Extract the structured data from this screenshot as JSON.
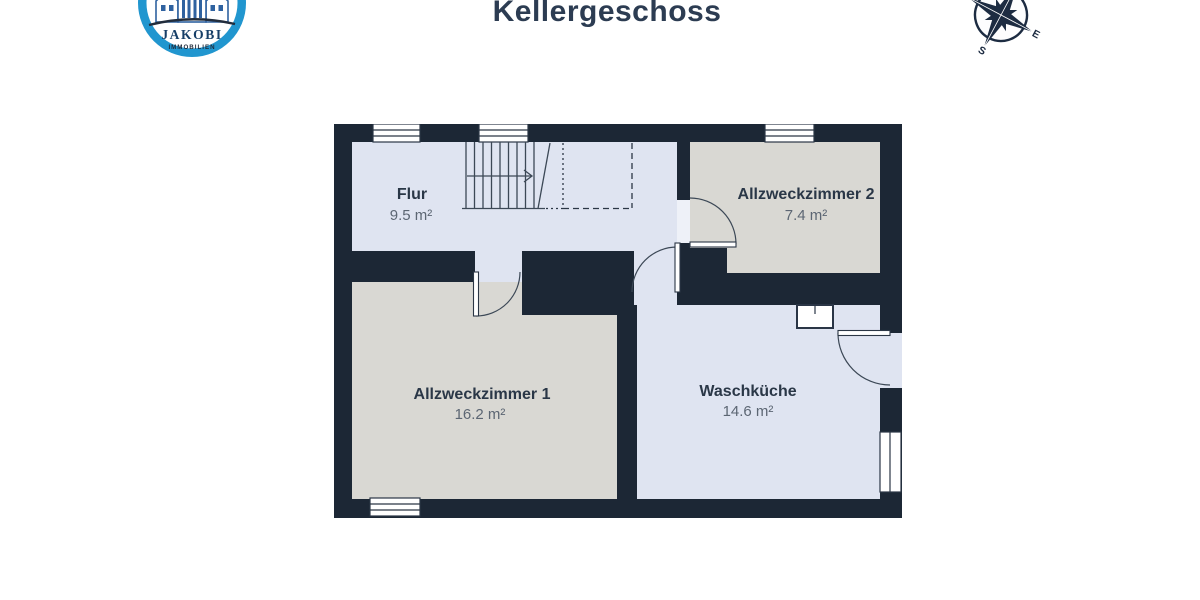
{
  "header": {
    "title": "Kellergeschoss",
    "title_color": "#2c3c52"
  },
  "logo": {
    "name": "JAKOBI",
    "subtitle": "IMMOBILIEN",
    "ring_color": "#2196cf",
    "building_color": "#2f62a0",
    "name_color": "#173f68",
    "subtitle_color": "#1d2838"
  },
  "compass": {
    "east": "E",
    "south": "S",
    "color": "#1d2c42"
  },
  "floorplan": {
    "wall_color": "#1c2735",
    "floor_color_hall": "#dfe4f1",
    "floor_color_rooms": "#d9d8d3",
    "line_color": "#3c4856",
    "rooms": [
      {
        "id": "flur",
        "name": "Flur",
        "area": "9.5 m²"
      },
      {
        "id": "az2",
        "name": "Allzweckzimmer 2",
        "area": "7.4 m²"
      },
      {
        "id": "az1",
        "name": "Allzweckzimmer 1",
        "area": "16.2 m²"
      },
      {
        "id": "wk",
        "name": "Waschküche",
        "area": "14.6 m²"
      }
    ]
  }
}
